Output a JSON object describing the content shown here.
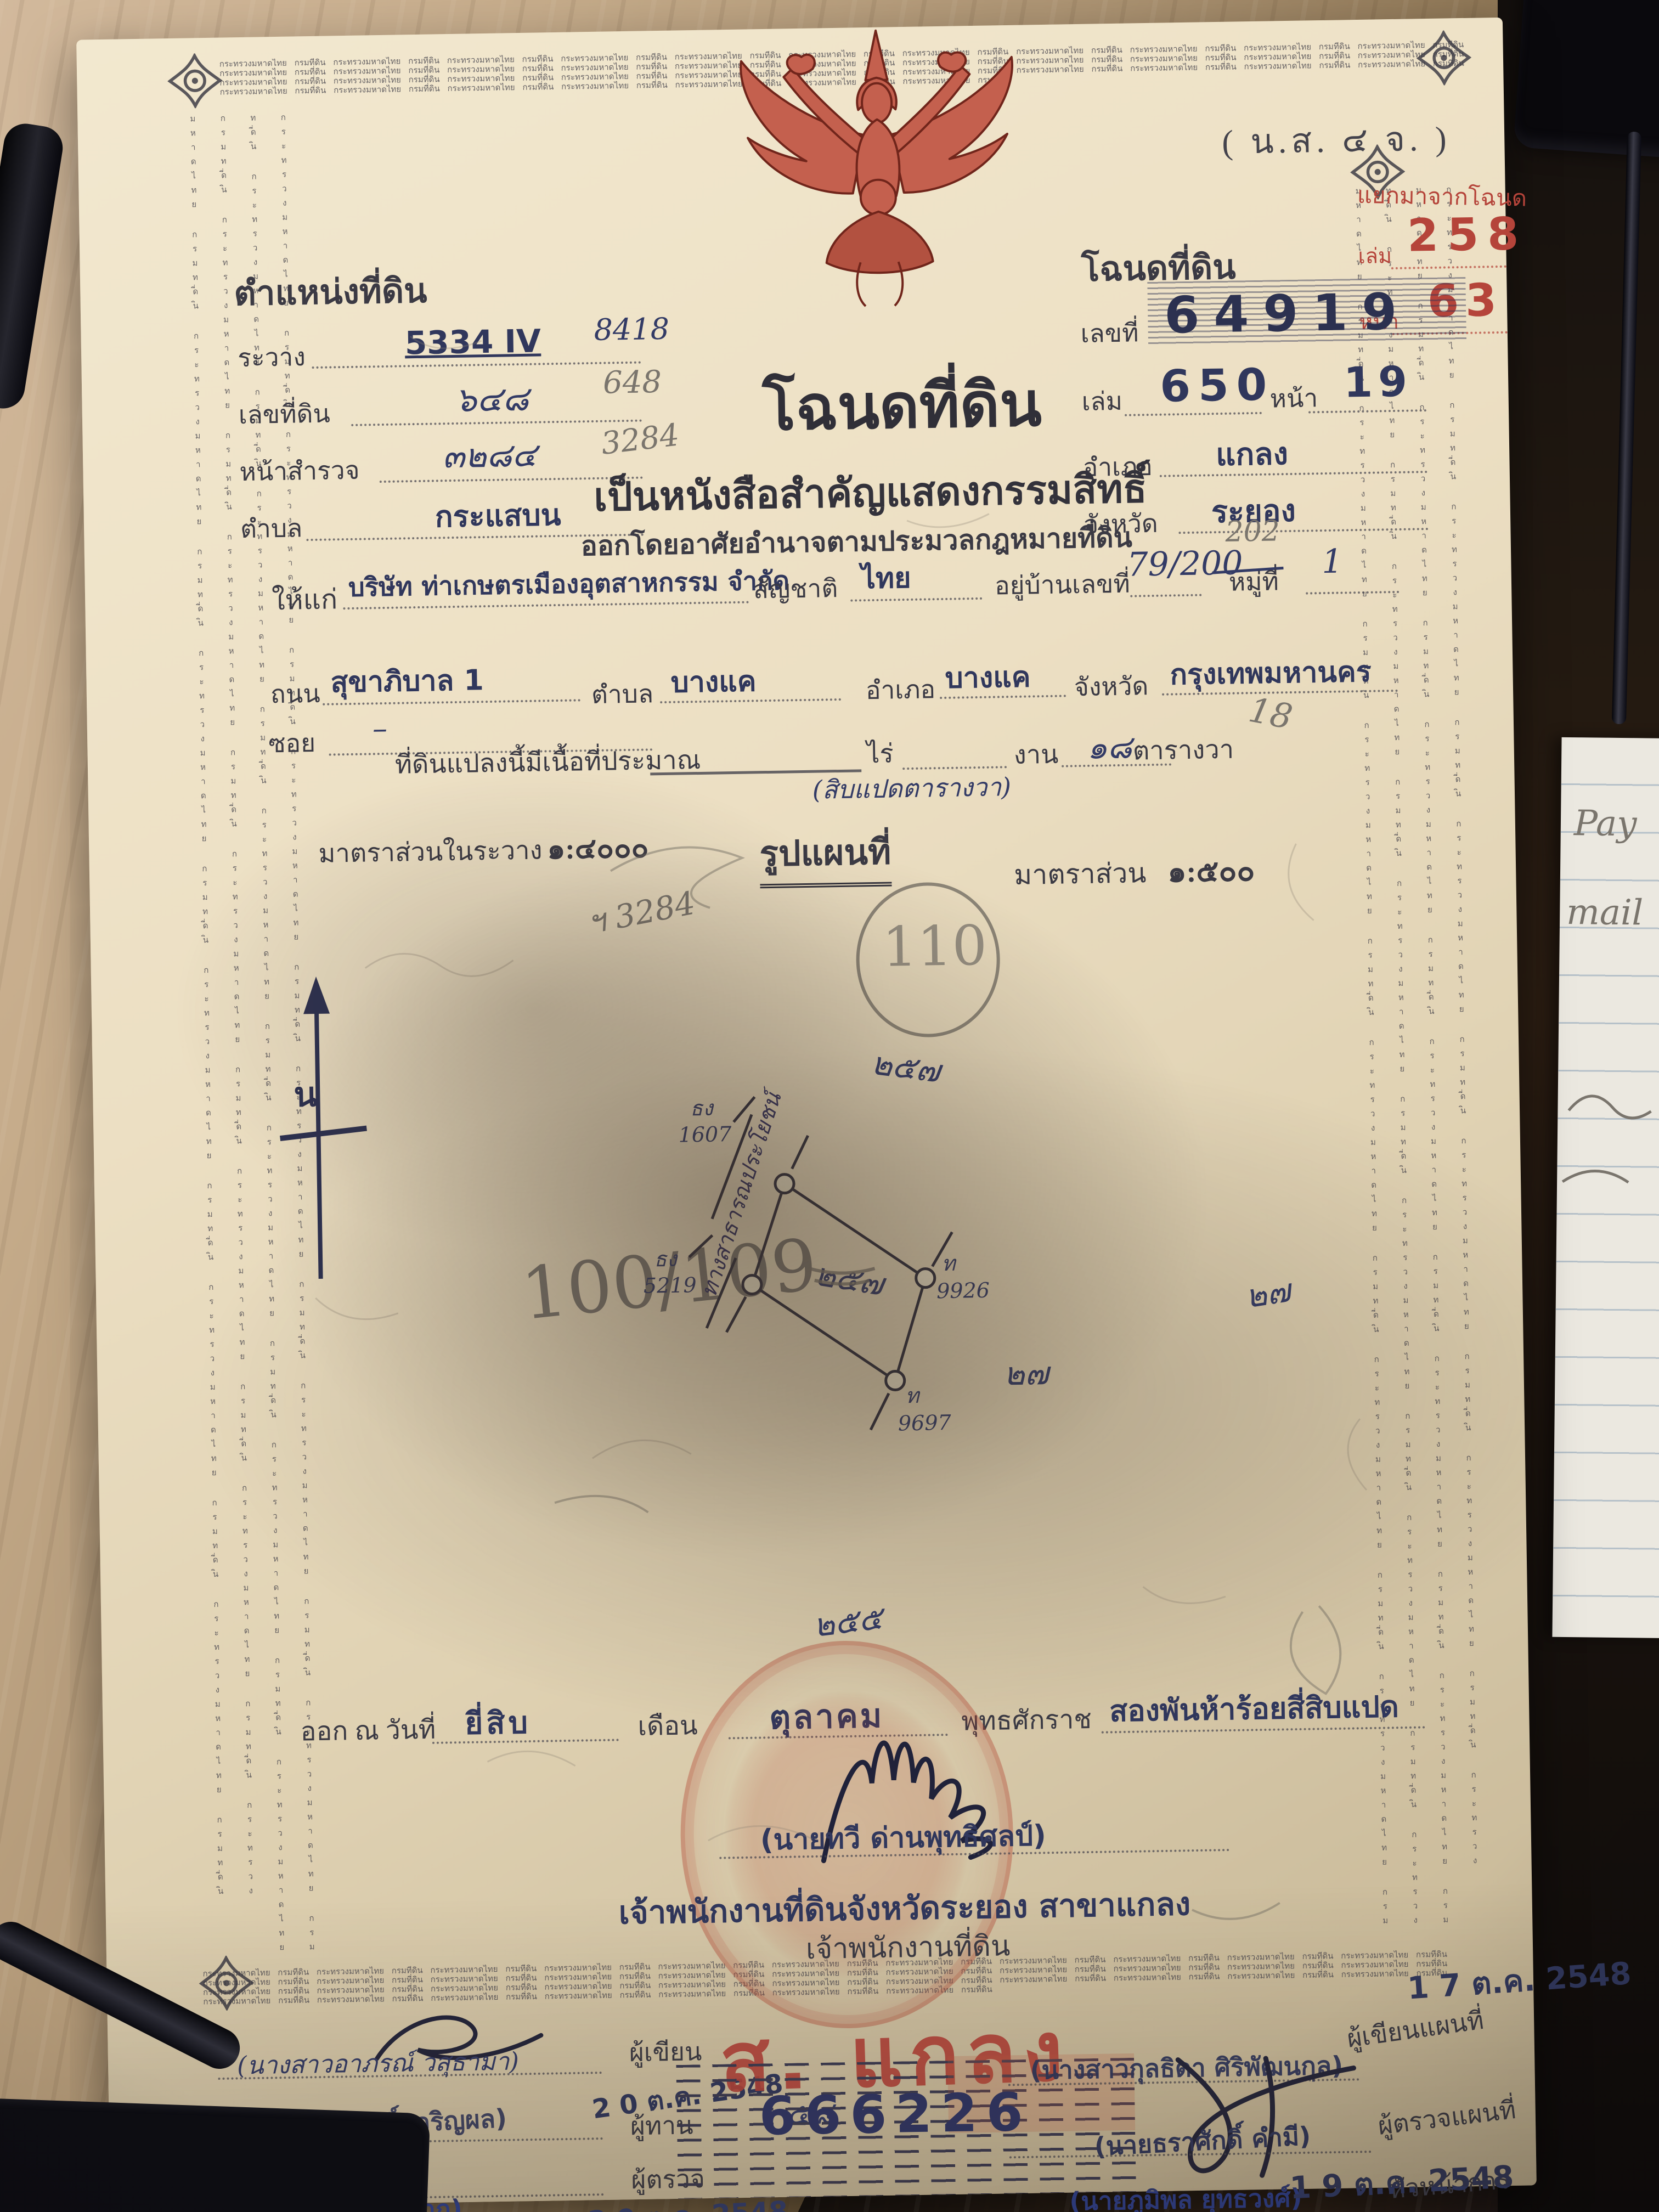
{
  "form_code": "( น.ส. ๔ จ. )",
  "border_microtext": "กระทรวงมหาดไทย กรมที่ดิน ",
  "separation_stamp": {
    "title": "แยกมาจากโฉนด",
    "volume_label": "เล่ม",
    "volume": "258",
    "page_label": "หน้า",
    "page": "63"
  },
  "position": {
    "title": "ตำแหน่งที่ดิน",
    "sheet_label": "ระวาง",
    "sheet": "5334 IV",
    "sheet_hand": "8418",
    "parcel_label": "เลขที่ดิน",
    "parcel": "๖๔๘",
    "parcel_pencil": "648",
    "survey_label": "หน้าสำรวจ",
    "survey": "๓๒๘๔",
    "survey_pencil": "3284",
    "subdistrict_label": "ตำบล",
    "subdistrict": "กระแสบน"
  },
  "deed": {
    "title": "โฉนดที่ดิน",
    "number_label": "เลขที่",
    "number": "64919",
    "volume_label": "เล่ม",
    "volume": "650",
    "page_label": "หน้า",
    "page": "19",
    "district_label": "อำเภอ",
    "district": "แกลง",
    "province_label": "จังหวัด",
    "province": "ระยอง"
  },
  "heading": {
    "main": "โฉนดที่ดิน",
    "subtitle": "เป็นหนังสือสำคัญแสดงกรรมสิทธิ์",
    "authority": "ออกโดยอาศัยอำนาจตามประมวลกฎหมายที่ดิน"
  },
  "grantee": {
    "to_label": "ให้แก่",
    "name": "บริษัท ท่าเกษตรเมืองอุตสาหกรรม จำกัด",
    "nationality_label": "สัญชาติ",
    "nationality": "ไทย",
    "address_label": "อยู่บ้านเลขที่",
    "address": "79/200",
    "moo_label": "หมู่ที่",
    "moo": "1",
    "address_pencil": "202",
    "road_label": "ถนน",
    "road": "สุขาภิบาล 1",
    "soi_label": "ซอย",
    "soi": "–",
    "subdistrict_label": "ตำบล",
    "subdistrict": "บางแค",
    "district_label": "อำเภอ",
    "district": "บางแค",
    "province_label": "จังหวัด",
    "province": "กรุงเทพมหานคร"
  },
  "land_area": {
    "prefix": "ที่ดินแปลงนี้มีเนื้อที่ประมาณ",
    "rai_label": "ไร่",
    "ngan_label": "งาน",
    "wa": "๑๘",
    "wa_label": "ตารางวา",
    "wa_pencil": "18",
    "spelled": "(สิบแปดตารางวา)"
  },
  "scale": {
    "sheet_label": "มาตราส่วนในระวาง",
    "sheet": "๑:๔๐๐๐",
    "map_title": "รูปแผนที่",
    "map_label": "มาตราส่วน",
    "map": "๑:๕๐๐",
    "pencil_note": "ฯ 3284"
  },
  "map": {
    "parcel_circle": "110",
    "pencil_ref": "100/109",
    "north": "น",
    "road": "ทางสาธารณประโยชน์",
    "marker_nw_a": "ธง",
    "marker_nw_b": "1607",
    "marker_w_a": "ธง",
    "marker_w_b": "5219",
    "marker_e_a": "ท",
    "marker_e_b": "9926",
    "marker_s_a": "ท",
    "marker_s_b": "9697",
    "neighbor_top": "๒๕๗",
    "neighbor_center": "๒๕๗",
    "neighbor_right": "๒๗",
    "neighbor_far_right": "๒๗",
    "neighbor_bottom": "๒๕๕"
  },
  "issue": {
    "prefix": "ออก ณ วันที่",
    "day": "ยี่สิบ",
    "month_label": "เดือน",
    "month": "ตุลาคม",
    "era_label": "พุทธศักราช",
    "year": "สองพันห้าร้อยสี่สิบแปด"
  },
  "signatory": {
    "name": "(นายทวี ด่านพุทธิศลป์)",
    "office_stamp": "เจ้าพนักงานที่ดินจังหวัดระยอง สาขาแกลง",
    "office": "เจ้าพนักงานที่ดิน"
  },
  "registrar": {
    "branch": "ส. แกลง",
    "serial": "666226"
  },
  "officials": {
    "writer": {
      "name": "(นางสาวอาภรณ์ วสุธามา)",
      "role": "ผู้เขียน",
      "date": "2 0 ต.ค. 2548"
    },
    "checker": {
      "name": "(นายผดุงศักดิ์ เจริญผล)",
      "role": "ผู้ทาน",
      "note": "๕๘"
    },
    "examiner": {
      "name": "(นายบุญศักดิ์ ดีมาก)",
      "role": "ผู้ตรวจ",
      "date": "2 0 ต.ค. 2548"
    },
    "map_writer": {
      "name": "(นางสาวกุลธิดา ศิริพัฒนกุล)",
      "role": "ผู้เขียนแผนที่",
      "date": "1 7 ต.ค. 2548"
    },
    "map_checker": {
      "name": "(นายธราศักดิ์ คำมี)",
      "role": "ผู้ตรวจแผนที่"
    },
    "chief": {
      "role": "หัวหน้าการ"
    },
    "approver": {
      "name": "(นายภูมิพล ยุทธวงศ์)",
      "date": "1 9 ต.ค. 2548"
    }
  },
  "desk": {
    "note_word_1": "Pay",
    "note_word_2": "mail"
  }
}
